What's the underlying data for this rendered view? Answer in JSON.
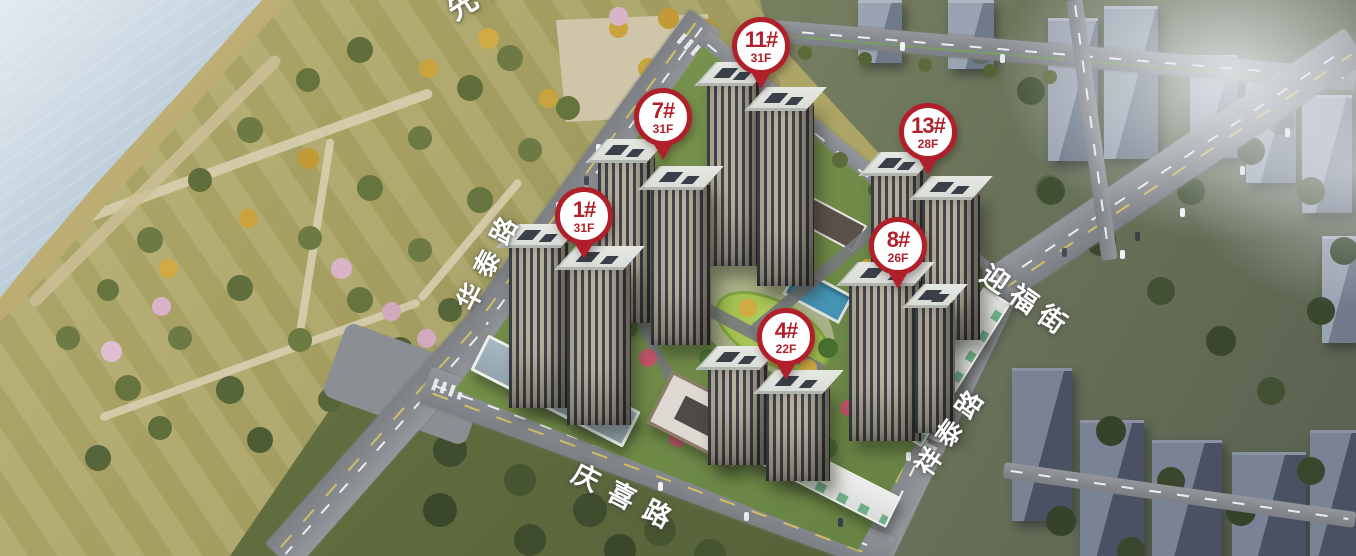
{
  "map_title": "residential-development-aerial-map",
  "area_labels": {
    "top_left_partial": "先锋创意"
  },
  "roads": {
    "west": "华泰路",
    "south": "庆喜路",
    "east": "祥泰路",
    "northeast": "迎福街"
  },
  "pins": [
    {
      "building": "1#",
      "floors": "31F",
      "x": 584,
      "y": 216
    },
    {
      "building": "4#",
      "floors": "22F",
      "x": 786,
      "y": 337
    },
    {
      "building": "7#",
      "floors": "31F",
      "x": 663,
      "y": 117
    },
    {
      "building": "8#",
      "floors": "26F",
      "x": 898,
      "y": 246
    },
    {
      "building": "11#",
      "floors": "31F",
      "x": 761,
      "y": 46
    },
    {
      "building": "13#",
      "floors": "28F",
      "x": 928,
      "y": 132
    }
  ],
  "colors": {
    "pin_red": "#b01f2a",
    "water": "#a9bfd0",
    "park_green": "#aca566",
    "road_gray": "#8b8e93",
    "city_building": "#8d97a7",
    "pool_blue": "#4695b6"
  }
}
